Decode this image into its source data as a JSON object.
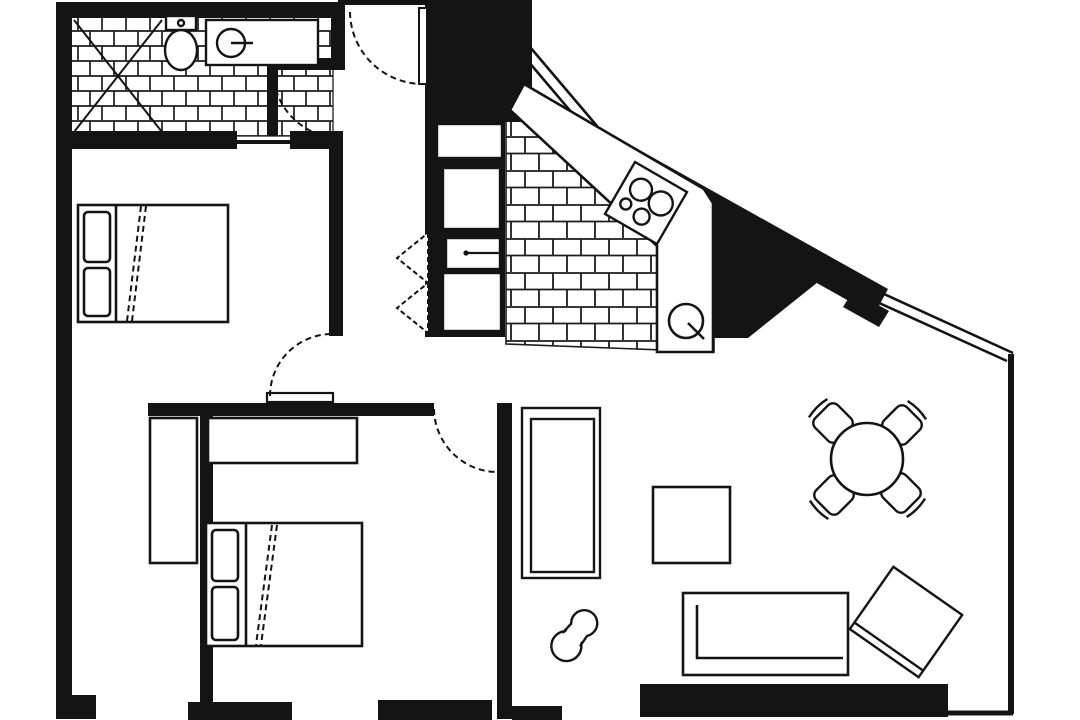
{
  "page": {
    "description": "Black and white scanned architectural floor plan of an apartment, no text labels",
    "canvas": {
      "width": 1080,
      "height": 720
    }
  },
  "palette": {
    "ink": "#141414",
    "paper": "#ffffff",
    "tile_line": "#1c1c1c"
  },
  "rooms": [
    {
      "name": "bathroom",
      "floor": "brick-tile",
      "fixtures": [
        "corner-shower",
        "toilet",
        "bathtub-with-faucet",
        "entry-vestibule-with-door"
      ]
    },
    {
      "name": "bedroom-1",
      "floor": "plain",
      "furniture": [
        "double-bed-two-pillows",
        "swing-door"
      ]
    },
    {
      "name": "closet-nook",
      "floor": "plain",
      "furniture": [
        "wardrobe"
      ]
    },
    {
      "name": "bedroom-2",
      "floor": "plain",
      "furniture": [
        "dresser",
        "double-bed-two-pillows",
        "swing-door"
      ]
    },
    {
      "name": "entry-hall",
      "floor": "plain",
      "furniture": [
        "entry-swing-door",
        "bifold-closet-doors"
      ]
    },
    {
      "name": "kitchen",
      "floor": "brick-tile",
      "fixtures": [
        "l-shaped-counter",
        "four-burner-stove",
        "round-sink",
        "appliance-column"
      ]
    },
    {
      "name": "living-dining-area",
      "floor": "plain",
      "furniture": [
        "round-dining-table",
        "four-dining-chairs",
        "shelf-unit",
        "coffee-table",
        "sofa",
        "angled-armchair",
        "floor-ornament"
      ]
    }
  ],
  "openings": {
    "swing_doors": 5,
    "bifold_doors": 1,
    "diagonal_windows": 2,
    "bottom_wall_window_gaps": 3
  }
}
